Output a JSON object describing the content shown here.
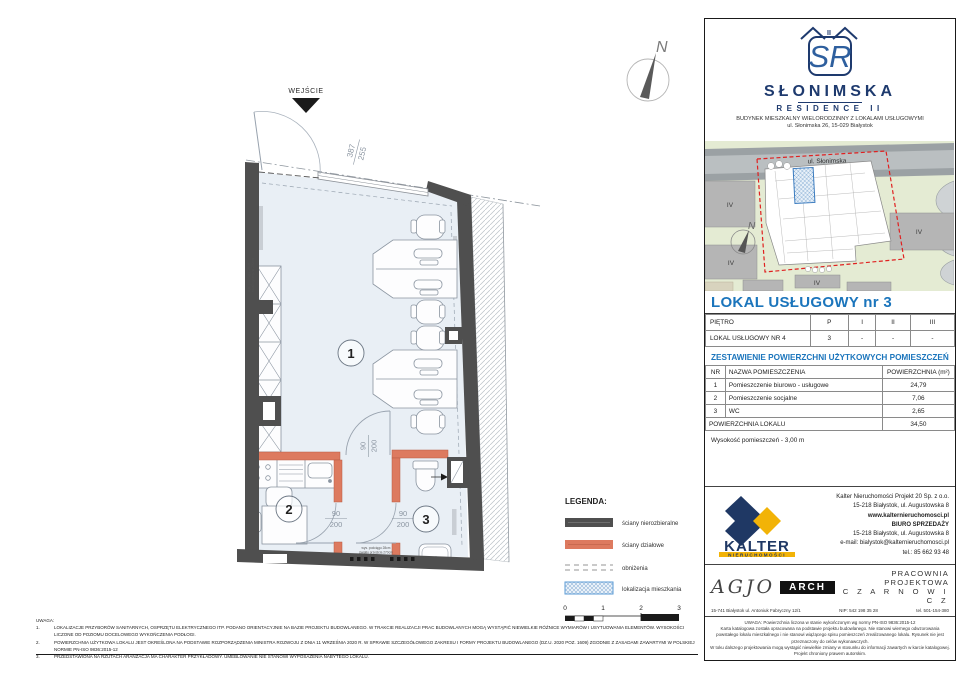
{
  "plan": {
    "entrance_label": "WEJŚCIE",
    "entry_dim": {
      "num": "387",
      "den": "255"
    },
    "door_dim": {
      "num": "90",
      "den": "200"
    },
    "rooms": [
      {
        "number": "1"
      },
      {
        "number": "2"
      },
      {
        "number": "3"
      }
    ],
    "north_label": "N",
    "beam_note": {
      "line1": "wys. podciągu 28cm",
      "line2": "światło przejścia 270cm"
    }
  },
  "legend": {
    "title": "LEGENDA:",
    "items": [
      {
        "label": "ściany nierozbieralne"
      },
      {
        "label": "ściany działowe"
      },
      {
        "label": "obniżenia"
      },
      {
        "label": "lokalizacja mieszkania"
      }
    ],
    "scale_labels": [
      "0",
      "1",
      "2",
      "3"
    ]
  },
  "notes": {
    "heading": "UWAGA:",
    "nums": [
      "1.",
      "2.",
      "3."
    ],
    "items": [
      "LOKALIZACJE PRZYBORÓW SANITARNYCH, OSPRZĘTU ELEKTRYCZNEGO ITP. PODANO ORIENTACYJNIE NA BAZIE PROJEKTU BUDOWLANEGO. W TRAKCIE REALIZACJI PRAC BUDOWLANYCH MOGĄ WYSTĄPIĆ NIEWIELKIE RÓŻNICE WYMIARÓW I USYTUOWANIA ELEMENTÓW. WYSOKOŚCI LICZONE OD POZIOMU DOCELOWEGO WYKOŃCZENIA PODŁOGI.",
      "POWIERZCHNIA UŻYTKOWA LOKALU JEST OKREŚLONA NA PODSTAWIE ROZPORZĄDZENIA MINISTRA ROZWOJU Z DNIA 11 WRZEŚNIA 2020 R. W SPRAWIE SZCZEGÓŁOWEGO ZAKRESU I FORMY PROJEKTU BUDOWLANEGO (DZ.U. 2020 POZ. 1609) ZGODNIE Z ZASADAMI ZAWARTYMI W POLSKIEJ NORMIE PN-ISO 9836:2015-12",
      "PRZEDSTAWIONA NA RZUTACH ARANŻACJA MA CHARAKTER PRZYKŁADOWY. UMEBLOWANIE NIE STANOWI WYPOSAŻENIA NABYTEGO LOKALU."
    ]
  },
  "panel": {
    "logo": {
      "monogram": "SR",
      "roman": "II",
      "name": "SŁONIMSKA",
      "subname": "RESIDENCE II",
      "desc": "BUDYNEK MIESZKALNY WIELORODZINNY Z LOKALAMI USŁUGOWYMI",
      "address": "ul. Słonimska 26, 15-029 Białystok"
    },
    "siteplan": {
      "street": "ul. Słonimska",
      "block_label": "IV",
      "north_label": "N"
    },
    "title": "LOKAL USŁUGOWY  nr 3",
    "floor_table": {
      "header": [
        "PIĘTRO",
        "P",
        "I",
        "II",
        "III"
      ],
      "row": [
        "LOKAL USŁUGOWY NR 4",
        "3",
        "-",
        "-",
        "-"
      ]
    },
    "area_heading": "ZESTAWIENIE POWIERZCHNI UŻYTKOWYCH POMIESZCZEŃ",
    "area_table": {
      "headers": [
        "NR",
        "NAZWA POMIESZCZENIA",
        "POWIERZCHNIA (m²)"
      ],
      "rows": [
        [
          "1",
          "Pomieszczenie biurowo - usługowe",
          "24,79"
        ],
        [
          "2",
          "Pomieszczenie socjalne",
          "7,06"
        ],
        [
          "3",
          "WC",
          "2,65"
        ]
      ],
      "total_label": "POWIERZCHNIA LOKALU",
      "total_value": "34,50"
    },
    "height_note": "Wysokość pomieszczeń - 3,00 m",
    "developer": {
      "logo_name": "KALTER",
      "logo_sub": "NIERUCHOMOŚCI",
      "lines": [
        "Kalter Nieruchomości Projekt 20  Sp. z o.o.",
        "15-218 Białystok, ul. Augustowska 8",
        "www.kalternieruchomosci.pl",
        "BIURO SPRZEDAŻY",
        "15-218 Białystok, ul. Augustowska 8",
        "e-mail: bialystok@kalternieruchomosci.pl",
        "tel.: 85 662 93 48"
      ]
    },
    "studio": {
      "logo_script": "AGJO",
      "logo_box": "ARCH",
      "address": "15-741 Białystok    ul. Antoniuk Fabryczny  12/1",
      "name1": "PRACOWNIA PROJEKTOWA",
      "name2": "C Z A R N O W I C Z",
      "nip": "NIP:  542 198 35 28",
      "tel": "tel. 501-154-380"
    },
    "fineprint": [
      "UWAGA:   Powierzchnia liczona w stanie wykończonym wg normy PN-ISO 9836:2015-12",
      "Karta katalogowa została opracowana na podstawie projektu budowlanego. Nie stanowi wiernego odwzorowania powstałego lokalu mieszkalnego i nie stanowi wiążącego spisu pomieszczeń zrealizowanego lokalu. Rysunek nie jest przeznaczony do celów wykonawczych.",
      "W toku dalszego projektowania mogą wystąpić niewielkie zmiany w stosunku do informacji zawartych w karcie katalogowej. Projekt chroniony prawem autorskim."
    ]
  },
  "colors": {
    "accent_blue": "#1b75bc",
    "wall_dark": "#4f4f4f",
    "wall_partition": "#dd7a5f",
    "interior": "#e9eff5",
    "brand_navy": "#1f3864",
    "brand_yellow": "#f2b307",
    "site_boundary_red": "#e02020"
  }
}
